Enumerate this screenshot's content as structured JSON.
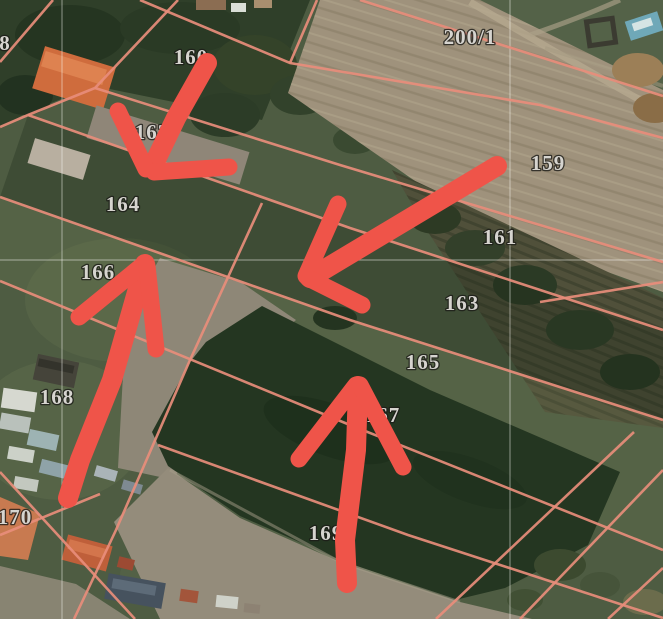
{
  "colors": {
    "parcel_line": "#e88d7b",
    "annotation_arrow": "#ef5449",
    "label_fill": "#d6d4cf",
    "label_halo": "#1c1c18",
    "grid_line": "rgba(250,250,245,0.42)"
  },
  "map": {
    "kind": "cadastral-parcel-overlay-on-satellite-imagery",
    "parcel_labels": [
      {
        "text": "8",
        "x": 5,
        "y": 43
      },
      {
        "text": "160",
        "x": 191,
        "y": 57
      },
      {
        "text": "200/1",
        "x": 470,
        "y": 37
      },
      {
        "text": "162",
        "x": 152,
        "y": 132
      },
      {
        "text": "159",
        "x": 548,
        "y": 163
      },
      {
        "text": "164",
        "x": 123,
        "y": 204
      },
      {
        "text": "161",
        "x": 500,
        "y": 237
      },
      {
        "text": "166",
        "x": 98,
        "y": 272
      },
      {
        "text": "163",
        "x": 462,
        "y": 303
      },
      {
        "text": "165",
        "x": 423,
        "y": 362
      },
      {
        "text": "167",
        "x": 383,
        "y": 415
      },
      {
        "text": "168",
        "x": 57,
        "y": 397
      },
      {
        "text": "170",
        "x": 15,
        "y": 517
      },
      {
        "text": "169",
        "x": 326,
        "y": 533
      }
    ],
    "boundary_lines": [
      {
        "id": "strip-north-1",
        "points": [
          [
            360,
            0
          ],
          [
            663,
            96
          ]
        ]
      },
      {
        "id": "strip-north-2",
        "points": [
          [
            140,
            0
          ],
          [
            290,
            63
          ],
          [
            540,
            105
          ],
          [
            663,
            138
          ]
        ]
      },
      {
        "id": "cross-top",
        "points": [
          [
            317,
            0
          ],
          [
            290,
            63
          ]
        ]
      },
      {
        "id": "strip-3",
        "points": [
          [
            95,
            88
          ],
          [
            340,
            165
          ],
          [
            663,
            262
          ]
        ]
      },
      {
        "id": "strip-4",
        "points": [
          [
            28,
            115
          ],
          [
            350,
            228
          ],
          [
            663,
            330
          ]
        ]
      },
      {
        "id": "strip-5",
        "points": [
          [
            0,
            197
          ],
          [
            350,
            320
          ],
          [
            663,
            420
          ]
        ]
      },
      {
        "id": "strip-6",
        "points": [
          [
            0,
            281
          ],
          [
            350,
            425
          ],
          [
            663,
            550
          ]
        ]
      },
      {
        "id": "strip-7",
        "points": [
          [
            158,
            445
          ],
          [
            408,
            535
          ],
          [
            663,
            618
          ]
        ]
      },
      {
        "id": "village-boundary",
        "points": [
          [
            178,
            0
          ],
          [
            95,
            88
          ],
          [
            28,
            115
          ],
          [
            0,
            127
          ]
        ]
      },
      {
        "id": "edge-top-left",
        "points": [
          [
            53,
            0
          ],
          [
            0,
            62
          ]
        ]
      },
      {
        "id": "cross-middle",
        "points": [
          [
            262,
            203
          ],
          [
            190,
            360
          ],
          [
            116,
            530
          ],
          [
            74,
            619
          ]
        ]
      },
      {
        "id": "scrub-edge-right",
        "points": [
          [
            540,
            302
          ],
          [
            663,
            282
          ]
        ]
      },
      {
        "id": "cross-bottom-right-1",
        "points": [
          [
            634,
            432
          ],
          [
            436,
            619
          ]
        ]
      },
      {
        "id": "cross-bottom-right-2",
        "points": [
          [
            663,
            470
          ],
          [
            520,
            619
          ]
        ]
      },
      {
        "id": "cross-bottom-right-3",
        "points": [
          [
            663,
            568
          ],
          [
            608,
            619
          ]
        ]
      },
      {
        "id": "village-plot-1",
        "points": [
          [
            0,
            472
          ],
          [
            135,
            619
          ]
        ]
      },
      {
        "id": "village-plot-2",
        "points": [
          [
            100,
            494
          ],
          [
            0,
            535
          ]
        ]
      }
    ],
    "grid_lines": {
      "vertical_x": [
        62,
        510
      ],
      "horizontal_y": [
        260
      ]
    },
    "annotation_arrows": [
      {
        "name": "arrow-down-left",
        "direction": "down-left",
        "shaft": [
          [
            207,
            63
          ],
          [
            176,
            118
          ],
          [
            152,
            168
          ]
        ],
        "head": [
          [
            [
              118,
              111
            ],
            [
              146,
              169
            ]
          ],
          [
            [
              154,
              172
            ],
            [
              229,
              167
            ]
          ]
        ]
      },
      {
        "name": "arrow-left",
        "direction": "left",
        "shaft": [
          [
            497,
            166
          ],
          [
            310,
            278
          ]
        ],
        "head": [
          [
            [
              338,
              204
            ],
            [
              306,
              276
            ]
          ],
          [
            [
              308,
              278
            ],
            [
              362,
              305
            ]
          ]
        ]
      },
      {
        "name": "arrow-up-center",
        "direction": "up",
        "shaft": [
          [
            358,
            386
          ],
          [
            356,
            450
          ],
          [
            345,
            540
          ],
          [
            347,
            583
          ]
        ],
        "head": [
          [
            [
              299,
              459
            ],
            [
              356,
              385
            ]
          ],
          [
            [
              360,
              385
            ],
            [
              403,
              467
            ]
          ]
        ]
      },
      {
        "name": "arrow-up-left",
        "direction": "up",
        "shaft": [
          [
            145,
            264
          ],
          [
            112,
            380
          ],
          [
            80,
            460
          ],
          [
            68,
            498
          ]
        ],
        "head": [
          [
            [
              79,
              317
            ],
            [
              144,
              264
            ]
          ],
          [
            [
              147,
              266
            ],
            [
              156,
              349
            ]
          ]
        ]
      }
    ]
  }
}
